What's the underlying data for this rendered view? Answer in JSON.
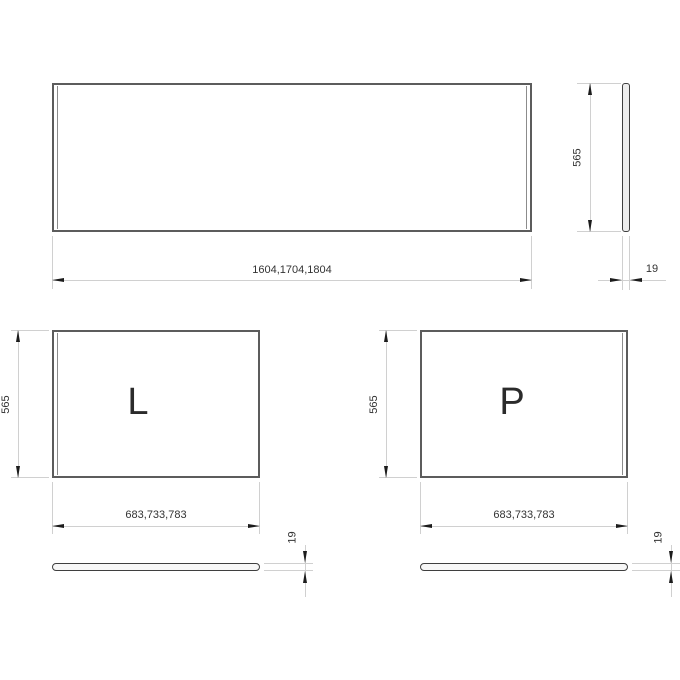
{
  "drawing": {
    "front_panel": {
      "width_label": "1604,1704,1804",
      "height_label": "565",
      "thickness_label": "19"
    },
    "left_panel": {
      "letter": "L",
      "width_label": "683,733,783",
      "height_label": "565",
      "thickness_label": "19"
    },
    "right_panel": {
      "letter": "P",
      "width_label": "683,733,783",
      "height_label": "565",
      "thickness_label": "19"
    },
    "colors": {
      "background": "#ffffff",
      "panel_outline": "#5c5c5c",
      "profile_outline": "#3f3f3f",
      "dimension_line": "#d0d0d0",
      "arrowhead": "#1c1c1c",
      "text": "#333333"
    }
  }
}
